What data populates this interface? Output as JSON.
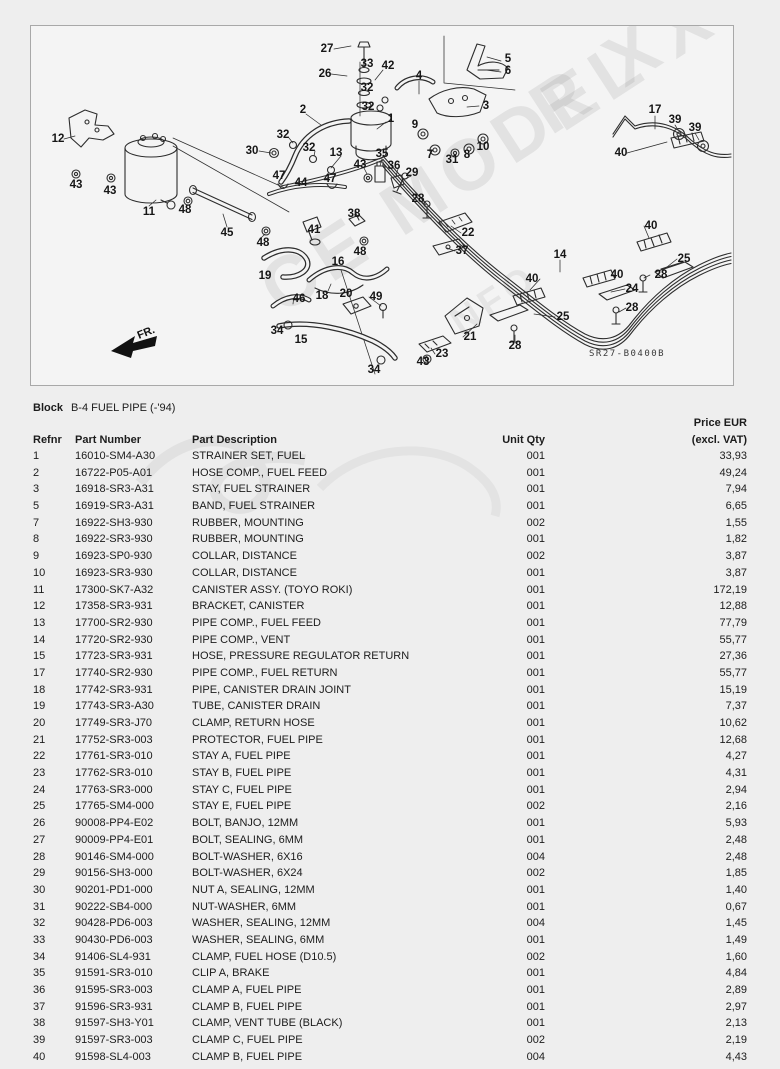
{
  "colors": {
    "background": "#eeeeee",
    "panel": "#f4f4f4",
    "line_art": "#2d2d2d",
    "text": "#1c1c1c"
  },
  "header": {
    "block_label": "Block",
    "block_title": "B-4 FUEL PIPE (-'94)"
  },
  "diagram": {
    "code": "SR27-B0400B",
    "front_label": "FR.",
    "watermark": [
      "R X",
      "CE MODEL X",
      "NFO"
    ],
    "callouts": [
      {
        "n": "27",
        "x": 296,
        "y": 23
      },
      {
        "n": "26",
        "x": 294,
        "y": 48
      },
      {
        "n": "33",
        "x": 336,
        "y": 38
      },
      {
        "n": "42",
        "x": 357,
        "y": 40
      },
      {
        "n": "32",
        "x": 336,
        "y": 62
      },
      {
        "n": "32",
        "x": 337,
        "y": 81
      },
      {
        "n": "2",
        "x": 272,
        "y": 84
      },
      {
        "n": "1",
        "x": 360,
        "y": 93
      },
      {
        "n": "4",
        "x": 388,
        "y": 50
      },
      {
        "n": "5",
        "x": 477,
        "y": 33
      },
      {
        "n": "6",
        "x": 477,
        "y": 45
      },
      {
        "n": "3",
        "x": 455,
        "y": 80
      },
      {
        "n": "9",
        "x": 384,
        "y": 99
      },
      {
        "n": "7",
        "x": 399,
        "y": 129
      },
      {
        "n": "31",
        "x": 421,
        "y": 134
      },
      {
        "n": "8",
        "x": 436,
        "y": 129
      },
      {
        "n": "10",
        "x": 452,
        "y": 121
      },
      {
        "n": "29",
        "x": 381,
        "y": 147
      },
      {
        "n": "30",
        "x": 221,
        "y": 125
      },
      {
        "n": "32",
        "x": 252,
        "y": 109
      },
      {
        "n": "32",
        "x": 278,
        "y": 122
      },
      {
        "n": "13",
        "x": 305,
        "y": 127
      },
      {
        "n": "43",
        "x": 329,
        "y": 139
      },
      {
        "n": "35",
        "x": 351,
        "y": 128
      },
      {
        "n": "36",
        "x": 363,
        "y": 140
      },
      {
        "n": "12",
        "x": 27,
        "y": 113
      },
      {
        "n": "43",
        "x": 45,
        "y": 159
      },
      {
        "n": "43",
        "x": 79,
        "y": 165
      },
      {
        "n": "11",
        "x": 118,
        "y": 186
      },
      {
        "n": "48",
        "x": 154,
        "y": 184
      },
      {
        "n": "45",
        "x": 196,
        "y": 207
      },
      {
        "n": "48",
        "x": 232,
        "y": 217
      },
      {
        "n": "19",
        "x": 234,
        "y": 250
      },
      {
        "n": "46",
        "x": 268,
        "y": 273
      },
      {
        "n": "18",
        "x": 291,
        "y": 270
      },
      {
        "n": "16",
        "x": 307,
        "y": 236
      },
      {
        "n": "20",
        "x": 315,
        "y": 268
      },
      {
        "n": "49",
        "x": 345,
        "y": 271
      },
      {
        "n": "34",
        "x": 246,
        "y": 305
      },
      {
        "n": "15",
        "x": 270,
        "y": 314
      },
      {
        "n": "34",
        "x": 343,
        "y": 344
      },
      {
        "n": "43",
        "x": 392,
        "y": 336
      },
      {
        "n": "23",
        "x": 411,
        "y": 328
      },
      {
        "n": "21",
        "x": 439,
        "y": 311
      },
      {
        "n": "47",
        "x": 248,
        "y": 150
      },
      {
        "n": "44",
        "x": 270,
        "y": 157
      },
      {
        "n": "47",
        "x": 299,
        "y": 153
      },
      {
        "n": "38",
        "x": 323,
        "y": 188
      },
      {
        "n": "41",
        "x": 283,
        "y": 204
      },
      {
        "n": "48",
        "x": 329,
        "y": 226
      },
      {
        "n": "28",
        "x": 387,
        "y": 173
      },
      {
        "n": "22",
        "x": 437,
        "y": 207
      },
      {
        "n": "37",
        "x": 431,
        "y": 225
      },
      {
        "n": "14",
        "x": 529,
        "y": 229
      },
      {
        "n": "40",
        "x": 501,
        "y": 253
      },
      {
        "n": "25",
        "x": 532,
        "y": 291
      },
      {
        "n": "28",
        "x": 484,
        "y": 320
      },
      {
        "n": "17",
        "x": 624,
        "y": 84
      },
      {
        "n": "39",
        "x": 644,
        "y": 94
      },
      {
        "n": "39",
        "x": 664,
        "y": 102
      },
      {
        "n": "40",
        "x": 590,
        "y": 127
      },
      {
        "n": "40",
        "x": 620,
        "y": 200
      },
      {
        "n": "25",
        "x": 653,
        "y": 233
      },
      {
        "n": "40",
        "x": 586,
        "y": 249
      },
      {
        "n": "28",
        "x": 630,
        "y": 249
      },
      {
        "n": "24",
        "x": 601,
        "y": 263
      },
      {
        "n": "28",
        "x": 601,
        "y": 282
      }
    ]
  },
  "table": {
    "headers": {
      "refnr": "Refnr",
      "part_number": "Part Number",
      "description": "Part Description",
      "qty": "Unit Qty",
      "price_line1": "Price EUR",
      "price_line2": "(excl. VAT)"
    },
    "rows": [
      [
        "1",
        "16010-SM4-A30",
        "STRAINER SET, FUEL",
        "001",
        "33,93"
      ],
      [
        "2",
        "16722-P05-A01",
        "HOSE COMP., FUEL FEED",
        "001",
        "49,24"
      ],
      [
        "3",
        "16918-SR3-A31",
        "STAY, FUEL STRAINER",
        "001",
        "7,94"
      ],
      [
        "5",
        "16919-SR3-A31",
        "BAND, FUEL STRAINER",
        "001",
        "6,65"
      ],
      [
        "7",
        "16922-SH3-930",
        "RUBBER, MOUNTING",
        "002",
        "1,55"
      ],
      [
        "8",
        "16922-SR3-930",
        "RUBBER, MOUNTING",
        "001",
        "1,82"
      ],
      [
        "9",
        "16923-SP0-930",
        "COLLAR, DISTANCE",
        "002",
        "3,87"
      ],
      [
        "10",
        "16923-SR3-930",
        "COLLAR, DISTANCE",
        "001",
        "3,87"
      ],
      [
        "11",
        "17300-SK7-A32",
        "CANISTER ASSY. (TOYO ROKI)",
        "001",
        "172,19"
      ],
      [
        "12",
        "17358-SR3-931",
        "BRACKET, CANISTER",
        "001",
        "12,88"
      ],
      [
        "13",
        "17700-SR2-930",
        "PIPE COMP., FUEL FEED",
        "001",
        "77,79"
      ],
      [
        "14",
        "17720-SR2-930",
        "PIPE COMP., VENT",
        "001",
        "55,77"
      ],
      [
        "15",
        "17723-SR3-931",
        "HOSE, PRESSURE REGULATOR RETURN",
        "001",
        "27,36"
      ],
      [
        "17",
        "17740-SR2-930",
        "PIPE COMP., FUEL RETURN",
        "001",
        "55,77"
      ],
      [
        "18",
        "17742-SR3-931",
        "PIPE, CANISTER DRAIN JOINT",
        "001",
        "15,19"
      ],
      [
        "19",
        "17743-SR3-A30",
        "TUBE, CANISTER DRAIN",
        "001",
        "7,37"
      ],
      [
        "20",
        "17749-SR3-J70",
        "CLAMP, RETURN HOSE",
        "001",
        "10,62"
      ],
      [
        "21",
        "17752-SR3-003",
        "PROTECTOR, FUEL PIPE",
        "001",
        "12,68"
      ],
      [
        "22",
        "17761-SR3-010",
        "STAY A, FUEL PIPE",
        "001",
        "4,27"
      ],
      [
        "23",
        "17762-SR3-010",
        "STAY B, FUEL PIPE",
        "001",
        "4,31"
      ],
      [
        "24",
        "17763-SR3-000",
        "STAY C, FUEL PIPE",
        "001",
        "2,94"
      ],
      [
        "25",
        "17765-SM4-000",
        "STAY E, FUEL PIPE",
        "002",
        "2,16"
      ],
      [
        "26",
        "90008-PP4-E02",
        "BOLT, BANJO, 12MM",
        "001",
        "5,93"
      ],
      [
        "27",
        "90009-PP4-E01",
        "BOLT, SEALING, 6MM",
        "001",
        "2,48"
      ],
      [
        "28",
        "90146-SM4-000",
        "BOLT-WASHER, 6X16",
        "004",
        "2,48"
      ],
      [
        "29",
        "90156-SH3-000",
        "BOLT-WASHER, 6X24",
        "002",
        "1,85"
      ],
      [
        "30",
        "90201-PD1-000",
        "NUT A, SEALING, 12MM",
        "001",
        "1,40"
      ],
      [
        "31",
        "90222-SB4-000",
        "NUT-WASHER, 6MM",
        "001",
        "0,67"
      ],
      [
        "32",
        "90428-PD6-003",
        "WASHER, SEALING, 12MM",
        "004",
        "1,45"
      ],
      [
        "33",
        "90430-PD6-003",
        "WASHER, SEALING, 6MM",
        "001",
        "1,49"
      ],
      [
        "34",
        "91406-SL4-931",
        "CLAMP, FUEL HOSE (D10.5)",
        "002",
        "1,60"
      ],
      [
        "35",
        "91591-SR3-010",
        "CLIP A, BRAKE",
        "001",
        "4,84"
      ],
      [
        "36",
        "91595-SR3-003",
        "CLAMP A, FUEL PIPE",
        "001",
        "2,89"
      ],
      [
        "37",
        "91596-SR3-931",
        "CLAMP B, FUEL PIPE",
        "001",
        "2,97"
      ],
      [
        "38",
        "91597-SH3-Y01",
        "CLAMP, VENT TUBE (BLACK)",
        "001",
        "2,13"
      ],
      [
        "39",
        "91597-SR3-003",
        "CLAMP C, FUEL PIPE",
        "002",
        "2,19"
      ],
      [
        "40",
        "91598-SL4-003",
        "CLAMP B, FUEL PIPE",
        "004",
        "4,43"
      ]
    ]
  }
}
